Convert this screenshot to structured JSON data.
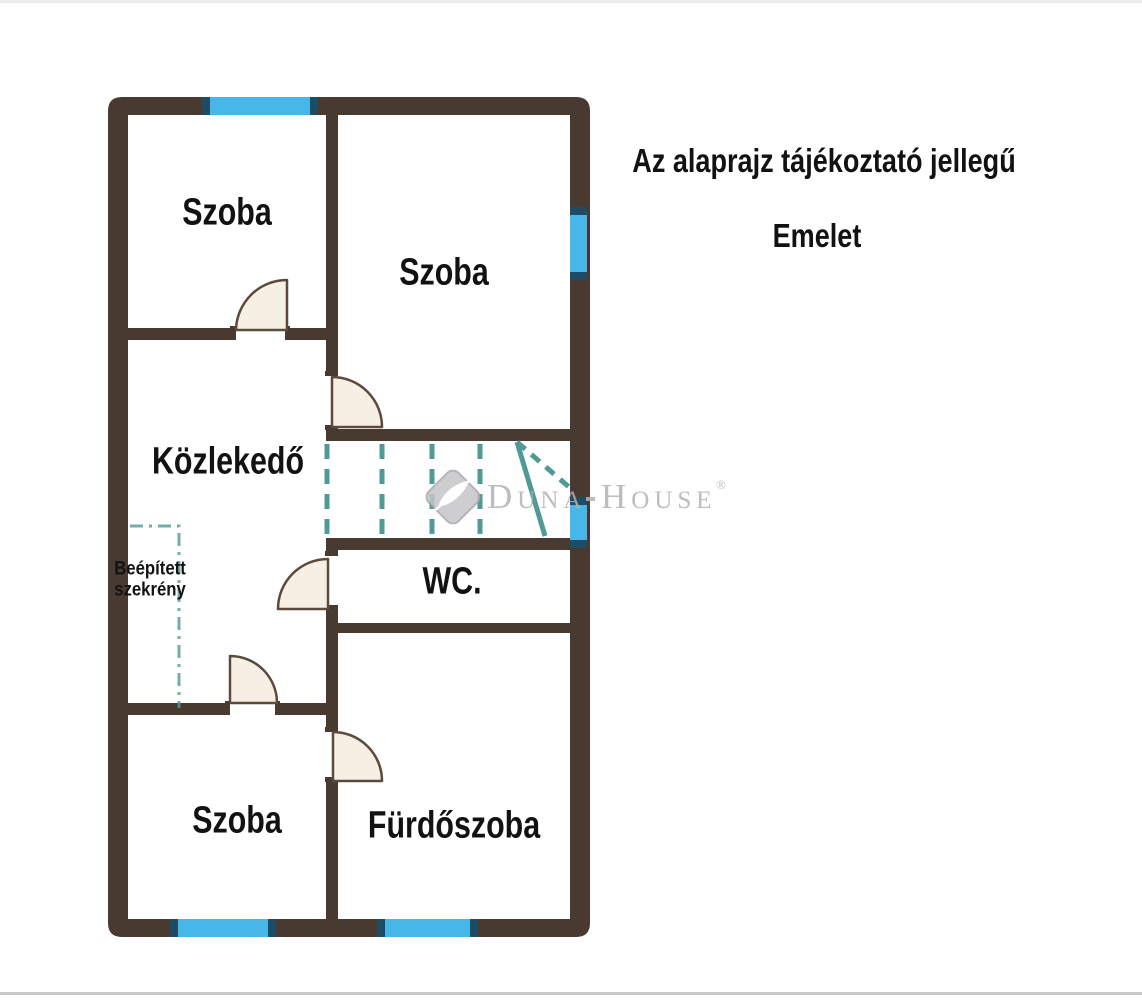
{
  "page": {
    "note": "Az alaprajz tájékoztató jellegű",
    "floor": "Emelet"
  },
  "rooms": [
    {
      "id": "room-top-left",
      "label": "Szoba"
    },
    {
      "id": "room-top-right",
      "label": "Szoba"
    },
    {
      "id": "hallway",
      "label": "Közlekedő"
    },
    {
      "id": "wc",
      "label": "WC."
    },
    {
      "id": "room-bottom-left",
      "label": "Szoba"
    },
    {
      "id": "bathroom",
      "label": "Fürdőszoba"
    }
  ],
  "annotations": {
    "built_in_closet": "Beépített szekrény"
  },
  "watermark": {
    "brand_1": "Duna",
    "brand_2": "House",
    "registered": "®"
  },
  "colors": {
    "wall": "#483931",
    "window": "#47b6e9",
    "window-cap": "#1e4c64",
    "stair": "#4f9a95",
    "door-fill": "#f6efe3",
    "door-stroke": "#5c4a3d",
    "label": "#121212",
    "watermark": "#b2b2b4"
  }
}
